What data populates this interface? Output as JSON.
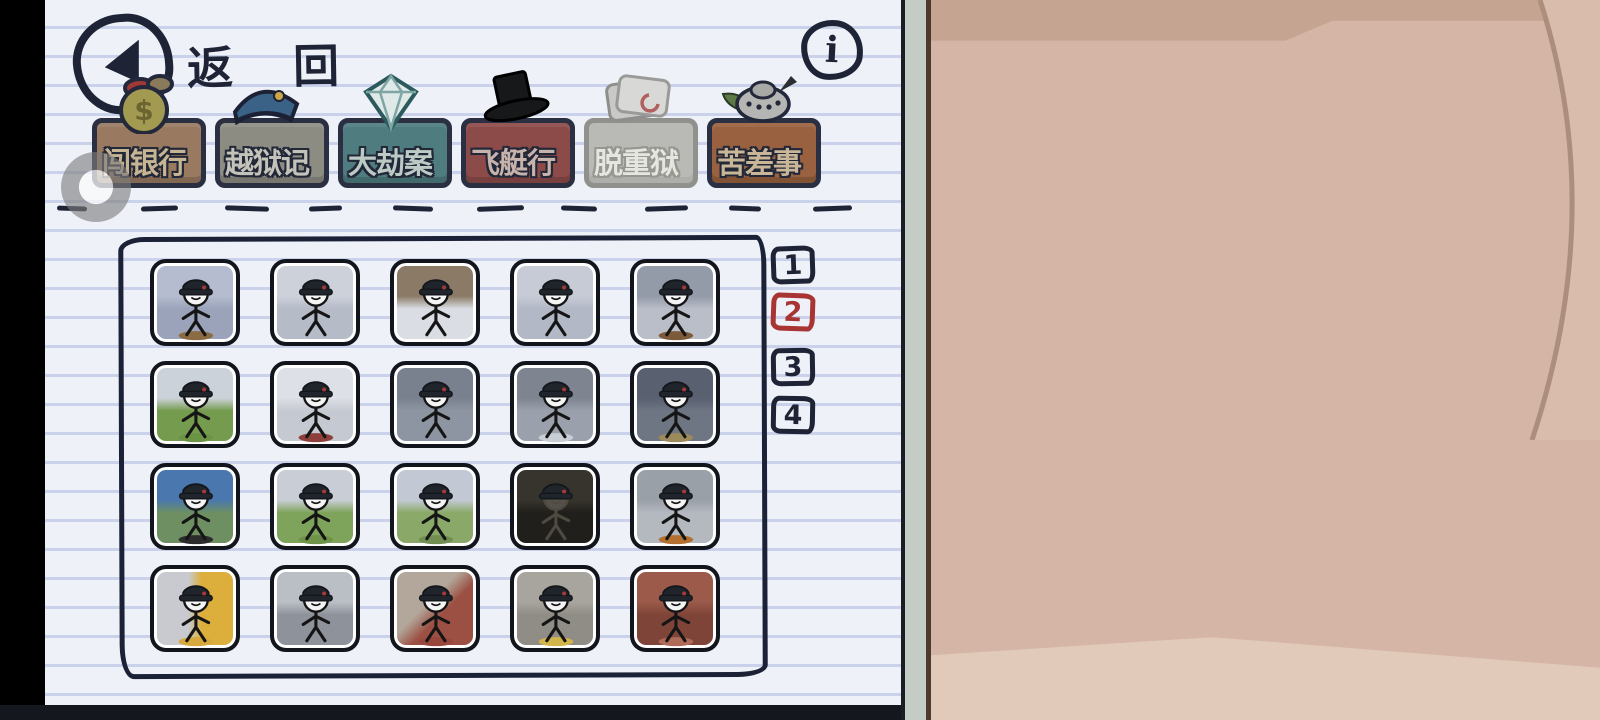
{
  "left_page": {
    "back_label": "返 回",
    "info_label": "i",
    "categories": [
      {
        "name": "tab-break-the-bank",
        "label": "闯银行",
        "icon": "money-bag-icon",
        "bg": "#997a61",
        "text": "#c6b493",
        "muted": false
      },
      {
        "name": "tab-escape-the-prison",
        "label": "越狱记",
        "icon": "police-hat-icon",
        "bg": "#8d8c83",
        "text": "#c3c3ba",
        "muted": false
      },
      {
        "name": "tab-steal-the-diamond",
        "label": "大劫案",
        "icon": "diamond-icon",
        "bg": "#4e7c7f",
        "text": "#bccac6",
        "muted": false
      },
      {
        "name": "tab-infiltrate-the-airship",
        "label": "飞艇行",
        "icon": "top-hat-icon",
        "bg": "#8c4a49",
        "text": "#c7b3ab",
        "muted": false
      },
      {
        "name": "tab-flee-the-complex",
        "label": "脱重狱",
        "icon": "folder-icon",
        "bg": "#b9b9b6",
        "text": "#e5e5e2",
        "muted": true
      },
      {
        "name": "tab-complete-the-mission",
        "label": "苦差事",
        "icon": "dome-icon",
        "bg": "#99613f",
        "text": "#c9b698",
        "muted": false
      }
    ],
    "pagination": {
      "pages": [
        "1",
        "2",
        "3",
        "4"
      ],
      "active_index": 1,
      "ink": "#1e2436",
      "active_color": "#a83434"
    },
    "characters": [
      {
        "name": "char-nest-soldier",
        "c1": "#b5bccf",
        "c2": "#9aa3ba",
        "dir": 180,
        "accent": "#8a6b42"
      },
      {
        "name": "char-rifle-soldier",
        "c1": "#cdd1da",
        "c2": "#b6bbc8",
        "dir": 180,
        "accent": "none"
      },
      {
        "name": "char-crouch-snow",
        "c1": "#8b7b66",
        "c2": "#dadde4",
        "dir": 180,
        "accent": "none"
      },
      {
        "name": "char-salute-soldier",
        "c1": "#c6cbd6",
        "c2": "#b3b8c6",
        "dir": 180,
        "accent": "none"
      },
      {
        "name": "char-hooded-mustache",
        "c1": "#939aa8",
        "c2": "#b9bec8",
        "dir": 180,
        "accent": "#7d5b3a"
      },
      {
        "name": "char-tank-hatch",
        "c1": "#ccd2d9",
        "c2": "#759c4e",
        "dir": 180,
        "accent": "#6b9445"
      },
      {
        "name": "char-fence-radio",
        "c1": "#dde0e6",
        "c2": "#c5c9d1",
        "dir": 180,
        "accent": "#8e3f3c"
      },
      {
        "name": "char-lean-gun",
        "c1": "#79818f",
        "c2": "#8e95a2",
        "dir": 180,
        "accent": "none"
      },
      {
        "name": "char-snow-wall",
        "c1": "#7e8490",
        "c2": "#9ba1ac",
        "dir": 180,
        "accent": "#c9cdd4"
      },
      {
        "name": "char-spear-guard",
        "c1": "#596070",
        "c2": "#6e7583",
        "dir": 180,
        "accent": "#9c8a5a"
      },
      {
        "name": "char-machinegun-snow",
        "c1": "#4a77ad",
        "c2": "#6d8f62",
        "dir": 180,
        "accent": "#2c2c2c"
      },
      {
        "name": "char-truck-front",
        "c1": "#c9ced6",
        "c2": "#7ea35b",
        "dir": 180,
        "accent": "#6e9449"
      },
      {
        "name": "char-turret-rider",
        "c1": "#c3c9d4",
        "c2": "#8aa968",
        "dir": 180,
        "accent": "#728e52"
      },
      {
        "name": "char-dark-raid",
        "c1": "#37342d",
        "c2": "#211f1b",
        "dir": 180,
        "accent": "none",
        "ink": "#4e4a41",
        "head": "#55514a"
      },
      {
        "name": "char-orange-beard",
        "c1": "#9aa0a8",
        "c2": "#b4b9c0",
        "dir": 180,
        "accent": "#b4702e"
      },
      {
        "name": "char-blonde-capture",
        "c1": "#c8cacf",
        "c2": "#dcaf3d",
        "dir": 90,
        "accent": "#d7a93c"
      },
      {
        "name": "char-rope-swing",
        "c1": "#babec5",
        "c2": "#8e929a",
        "dir": 180,
        "accent": "none"
      },
      {
        "name": "char-console-operator",
        "c1": "#b2a79a",
        "c2": "#9c5044",
        "dir": 135,
        "accent": "#99473d"
      },
      {
        "name": "char-blonde-mechanic",
        "c1": "#a8a59e",
        "c2": "#908d86",
        "dir": 180,
        "accent": "#d3b44a"
      },
      {
        "name": "char-brick-pistol",
        "c1": "#9b5a4a",
        "c2": "#7f4438",
        "dir": 180,
        "accent": "#b06a58"
      }
    ]
  },
  "card": {
    "serial": "264475368",
    "copyright": "(C) PuffballsUnited"
  }
}
